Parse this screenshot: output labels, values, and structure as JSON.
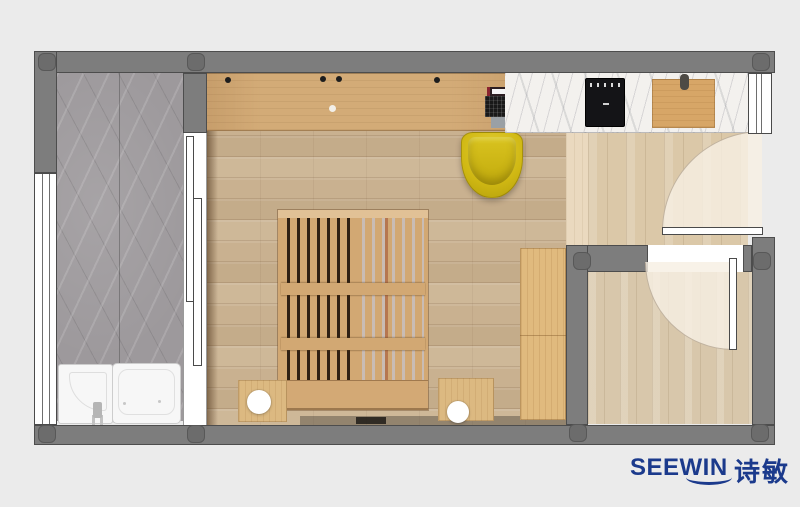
{
  "brand": {
    "logo_text": "SEEWIN",
    "logo_cjk": "诗敏",
    "logo_color": "#1b3a8c"
  },
  "palette": {
    "background": "#ebebeb",
    "wall": "#7d7d7d",
    "pillar": "#6c6c6c",
    "floor_main": "#c9b190",
    "floor_kitchen": "#dbc8a8",
    "floor_entry": "#d8c7ab",
    "desk_wood": "#d3ab77",
    "bed_wood": "#d2a873",
    "wardrobe_wood": "#e0ba7e",
    "counter_marble": "#f3f1ee",
    "balcony_marble": "#9d999c",
    "chair_yellow": "#d0b813",
    "cooktop_black": "#141417",
    "fixture_white": "#f7f7f7",
    "door_swing_overlay": "#f6efe3"
  },
  "floorplan": {
    "rooms": [
      "balcony-bath",
      "main-room",
      "kitchen-strip",
      "entry-room"
    ],
    "objects": [
      "left-window",
      "sliding-door",
      "shower-tray",
      "bathtub",
      "faucet",
      "desk-counter",
      "laptop",
      "desk-chair",
      "slatted-bed",
      "nightstand-left",
      "nightstand-right",
      "lamp-left",
      "lamp-right",
      "wardrobe",
      "marble-counter",
      "cooktop",
      "cutting-board",
      "kitchen-swing-door",
      "entry-swing-door",
      "right-window"
    ]
  }
}
